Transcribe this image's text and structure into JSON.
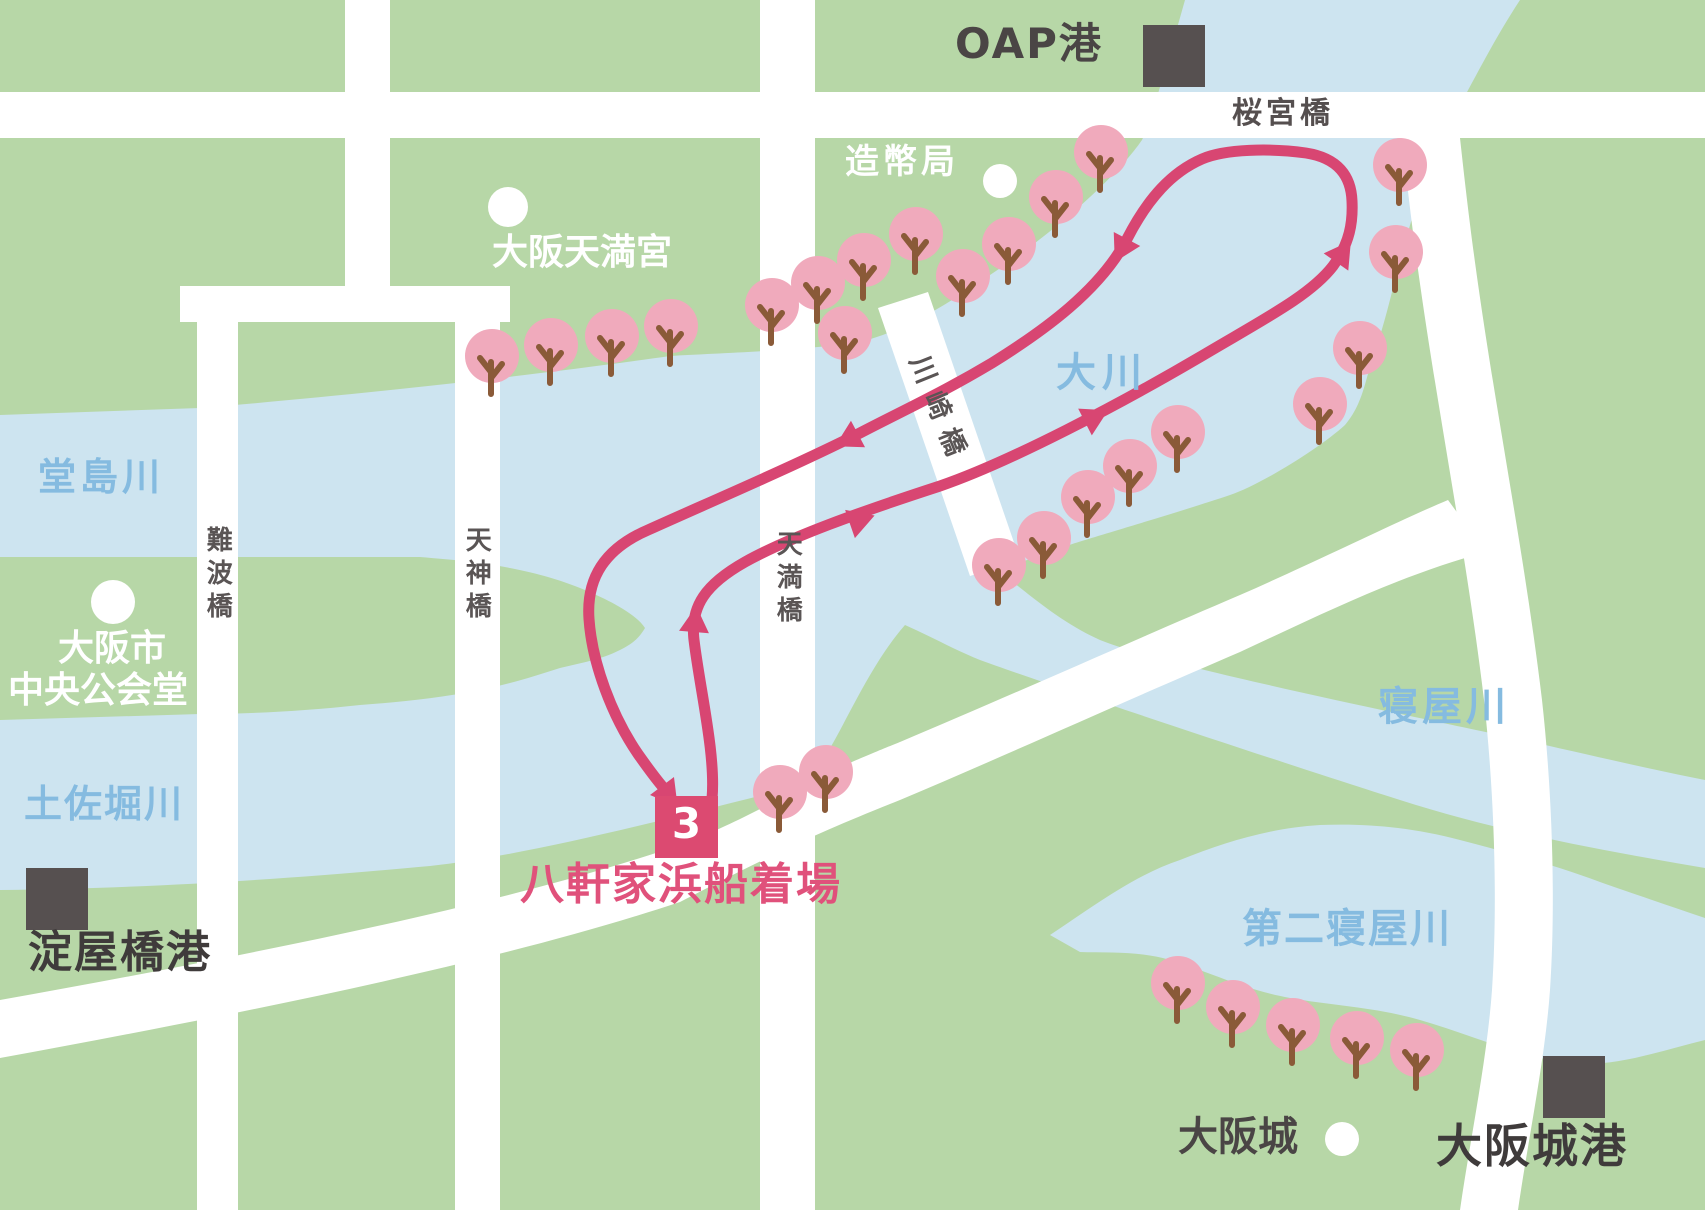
{
  "map": {
    "labels": {
      "oap_port": "OAP港",
      "sakuranomiya_bridge": "桜宮橋",
      "mint_bureau": "造幣局",
      "osaka_tenmangu": "大阪天満宮",
      "okawa_river": "大川",
      "kawasaki_bridge": "川崎橋",
      "dojima_river": "堂島川",
      "naniwa_bridge": "難波橋",
      "tenjin_bridge": "天神橋",
      "tenma_bridge": "天満橋",
      "city_hall_line1": "大阪市",
      "city_hall_line2": "中央公会堂",
      "tosabori_river": "土佐堀川",
      "yodoyabashi_port": "淀屋橋港",
      "pier_number": "3",
      "hachikenyahama_pier": "八軒家浜船着場",
      "neya_river": "寝屋川",
      "daini_neya_river": "第二寝屋川",
      "osaka_castle": "大阪城",
      "osaka_castle_port": "大阪城港"
    },
    "colors": {
      "land": "#b7d7a7",
      "water": "#cde4f0",
      "road": "#ffffff",
      "route": "#d84672",
      "tree": "#f0aabc",
      "trunk": "#8a5a38",
      "marker": "#dc4a71",
      "pier_label": "#e0517b",
      "water_label": "#85bbe0",
      "dark_label": "#4a4545",
      "port_square": "#565050"
    }
  }
}
